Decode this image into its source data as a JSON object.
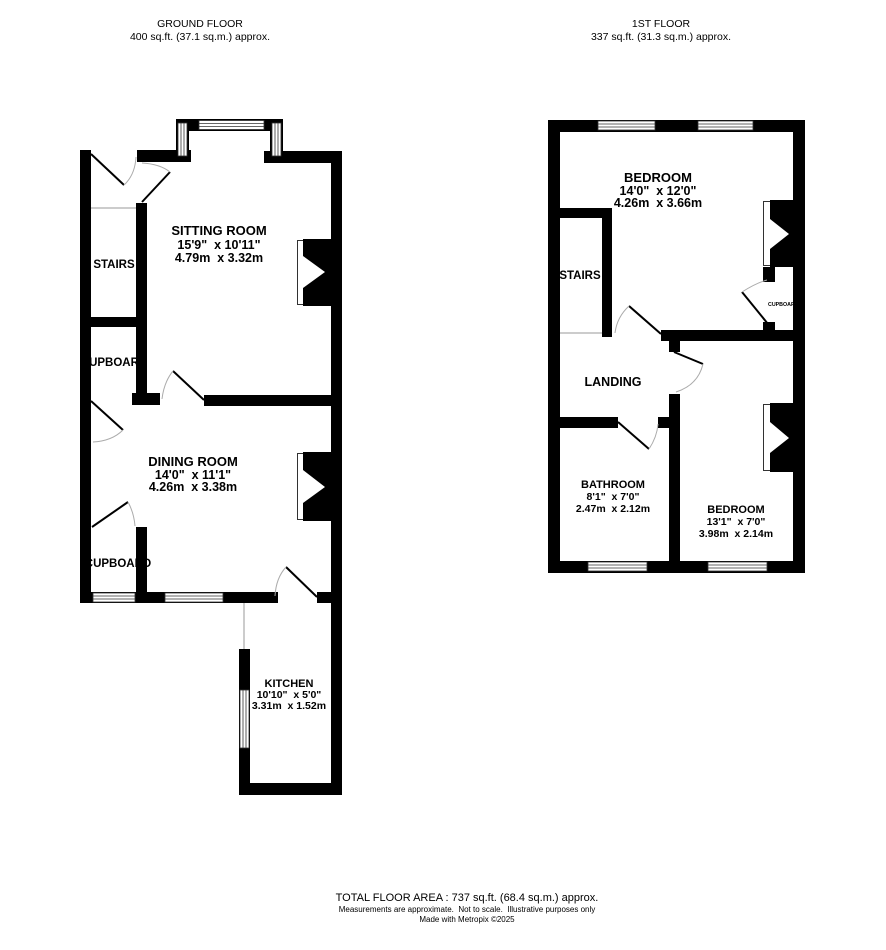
{
  "header": {
    "ground": {
      "title": "GROUND FLOOR",
      "area": "400 sq.ft. (37.1 sq.m.) approx."
    },
    "first": {
      "title": "1ST FLOOR",
      "area": "337 sq.ft. (31.3 sq.m.) approx."
    }
  },
  "ground_floor": {
    "sitting_room": {
      "name": "SITTING ROOM",
      "imperial": "15'9\"  x 10'11\"",
      "metric": "4.79m  x 3.32m"
    },
    "dining_room": {
      "name": "DINING ROOM",
      "imperial": "14'0\"  x 11'1\"",
      "metric": "4.26m  x 3.38m"
    },
    "kitchen": {
      "name": "KITCHEN",
      "imperial": "10'10\"  x 5'0\"",
      "metric": "3.31m  x 1.52m"
    },
    "stairs": "STAIRS",
    "cupboard_under_stairs": "CUPBOARD",
    "cupboard_rear": "CUPBOARD"
  },
  "first_floor": {
    "bedroom1": {
      "name": "BEDROOM",
      "imperial": "14'0\"  x 12'0\"",
      "metric": "4.26m  x 3.66m"
    },
    "bathroom": {
      "name": "BATHROOM",
      "imperial": "8'1\"  x 7'0\"",
      "metric": "2.47m  x 2.12m"
    },
    "bedroom2": {
      "name": "BEDROOM",
      "imperial": "13'1\"  x 7'0\"",
      "metric": "3.98m  x 2.14m"
    },
    "stairs": "STAIRS",
    "landing": "LANDING",
    "cupboard": "CUPBOARD"
  },
  "footer": {
    "total": "TOTAL FLOOR AREA : 737 sq.ft. (68.4 sq.m.) approx.",
    "disclaimer": "Measurements are approximate.  Not to scale.  Illustrative purposes only",
    "credit": "Made with Metropix ©2025"
  },
  "colors": {
    "wall": "#000000",
    "door_arc": "#ababab",
    "background": "#ffffff"
  }
}
